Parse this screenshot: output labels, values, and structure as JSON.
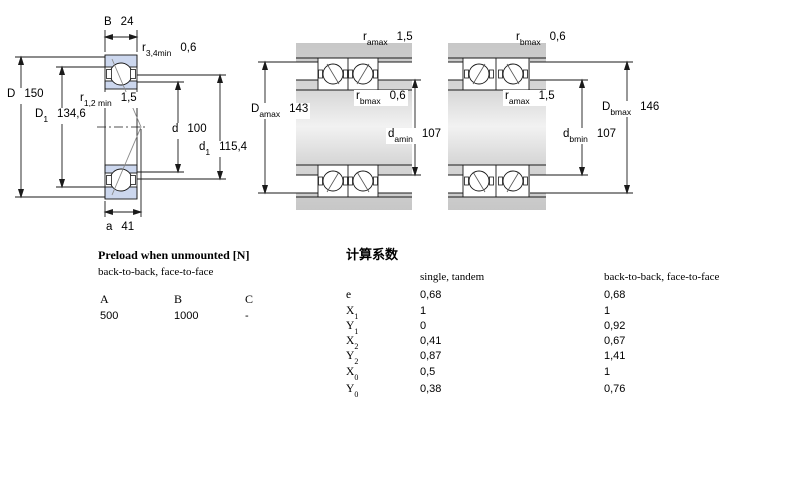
{
  "colors": {
    "bearing_ring_fill": "#ccd7ee",
    "housing_gray": "#d2d2d2",
    "line_black": "#1a1a1a",
    "contact_line_gray": "#8a8a8a"
  },
  "dims": {
    "B": {
      "sym": "B",
      "sub": "",
      "value": "24"
    },
    "r34": {
      "sym": "r",
      "sub": "3,4min",
      "value": "0,6"
    },
    "D": {
      "sym": "D",
      "sub": "",
      "value": "150"
    },
    "r12": {
      "sym": "r",
      "sub": "1,2 min",
      "value": "1,5"
    },
    "D1": {
      "sym": "D",
      "sub": "1",
      "value": "134,6"
    },
    "d": {
      "sym": "d",
      "sub": "",
      "value": "100"
    },
    "d1": {
      "sym": "d",
      "sub": "1",
      "value": "115,4"
    },
    "a": {
      "sym": "a",
      "sub": "",
      "value": "41"
    },
    "ramax_mid": {
      "sym": "r",
      "sub": "amax",
      "value": "1,5"
    },
    "Damax": {
      "sym": "D",
      "sub": "amax",
      "value": "143"
    },
    "rbmax_mid": {
      "sym": "r",
      "sub": "bmax",
      "value": "0,6"
    },
    "damin": {
      "sym": "d",
      "sub": "amin",
      "value": "107"
    },
    "rbmax_right": {
      "sym": "r",
      "sub": "bmax",
      "value": "0,6"
    },
    "ramax_right": {
      "sym": "r",
      "sub": "amax",
      "value": "1,5"
    },
    "Dbmax": {
      "sym": "D",
      "sub": "bmax",
      "value": "146"
    },
    "dbmin": {
      "sym": "d",
      "sub": "bmin",
      "value": "107"
    }
  },
  "preload": {
    "title": "Preload when unmounted [N]",
    "subtitle": "back-to-back, face-to-face",
    "columns": [
      "A",
      "B",
      "C"
    ],
    "values": [
      "500",
      "1000",
      "-"
    ]
  },
  "factors": {
    "title": "计算系数",
    "col1_header": "single, tandem",
    "col2_header": "back-to-back, face-to-face",
    "rows": [
      {
        "sym": "e",
        "sub": "",
        "v1": "0,68",
        "v2": "0,68"
      },
      {
        "sym": "X",
        "sub": "1",
        "v1": "1",
        "v2": "1"
      },
      {
        "sym": "Y",
        "sub": "1",
        "v1": "0",
        "v2": "0,92"
      },
      {
        "sym": "X",
        "sub": "2",
        "v1": "0,41",
        "v2": "0,67"
      },
      {
        "sym": "Y",
        "sub": "2",
        "v1": "0,87",
        "v2": "1,41"
      },
      {
        "sym": "X",
        "sub": "0",
        "v1": "0,5",
        "v2": "1"
      },
      {
        "sym": "Y",
        "sub": "0",
        "v1": "0,38",
        "v2": "0,76"
      }
    ]
  }
}
